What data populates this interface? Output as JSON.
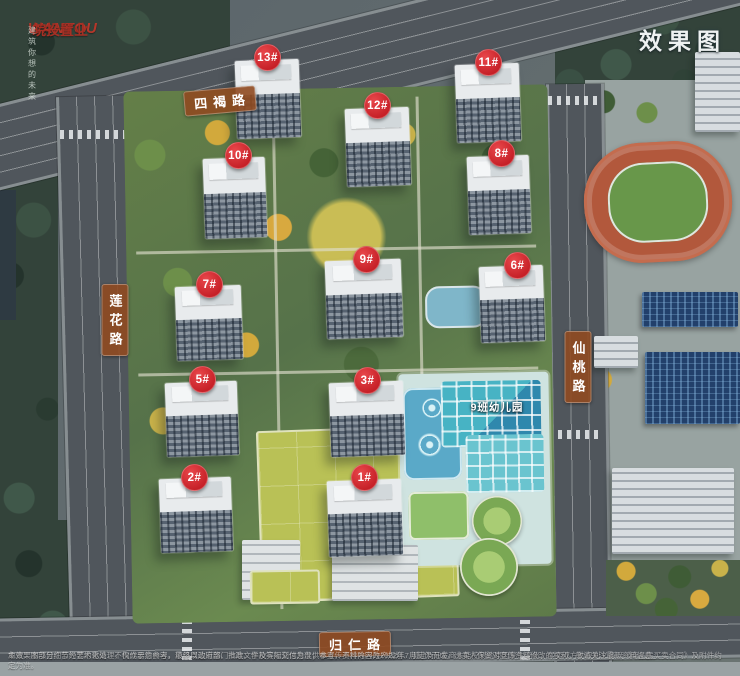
{
  "brand": {
    "logo_en": "WANTOU",
    "logo_cn": "皖投置业",
    "tagline": "建筑你想的未来"
  },
  "corner_tag": {
    "text": "效果图"
  },
  "roads": {
    "labels": [
      {
        "id": "north",
        "text": "四褐路",
        "orientation": "horizontal",
        "x": 220,
        "y": 101,
        "rotate": -5
      },
      {
        "id": "west",
        "text": "莲花路",
        "orientation": "vertical",
        "x": 115,
        "y": 320,
        "rotate": 0
      },
      {
        "id": "east",
        "text": "仙桃路",
        "orientation": "vertical",
        "x": 578,
        "y": 367,
        "rotate": 0
      },
      {
        "id": "south",
        "text": "归仁路",
        "orientation": "horizontal",
        "x": 355,
        "y": 644,
        "rotate": -1
      }
    ]
  },
  "markers": [
    {
      "label": "13#",
      "x": 267,
      "y": 57
    },
    {
      "label": "12#",
      "x": 377,
      "y": 105
    },
    {
      "label": "11#",
      "x": 488,
      "y": 62
    },
    {
      "label": "10#",
      "x": 238,
      "y": 155
    },
    {
      "label": "8#",
      "x": 501,
      "y": 153
    },
    {
      "label": "9#",
      "x": 366,
      "y": 259
    },
    {
      "label": "7#",
      "x": 209,
      "y": 284
    },
    {
      "label": "6#",
      "x": 517,
      "y": 265
    },
    {
      "label": "5#",
      "x": 202,
      "y": 379
    },
    {
      "label": "3#",
      "x": 367,
      "y": 380
    },
    {
      "label": "2#",
      "x": 194,
      "y": 477
    },
    {
      "label": "1#",
      "x": 364,
      "y": 477
    }
  ],
  "site": {
    "kindergarten_label": {
      "text": "9班幼儿园",
      "x": 497,
      "y": 407
    }
  },
  "colors": {
    "marker_red": "#d8262c",
    "banner_brown": "#8f4a20",
    "brand_red": "#b5372a",
    "track_orange": "#b2583c",
    "field_green": "#68974a",
    "kindergarten_teal": "#47b3c4"
  },
  "disclaimer": {
    "line1": "免责：本项目广告为要约邀请，不构成要约内容。项目周边道路、市政、学校等规划信息仅供参考，不排除因政府规划、规定及开发商未能控制的原因发生变化，买卖双方的权利义务以《商品房买卖合同》及附件约定为准。",
    "line2": "本效果图部分细节经艺术化处理，仅作示意参考，最终以政府部门批准文件及实际交付为准；本宣传资料内容为2022年7月制作而成，出卖人保留对宣传资料修改的权利，敬请关注最新资料信息。"
  }
}
